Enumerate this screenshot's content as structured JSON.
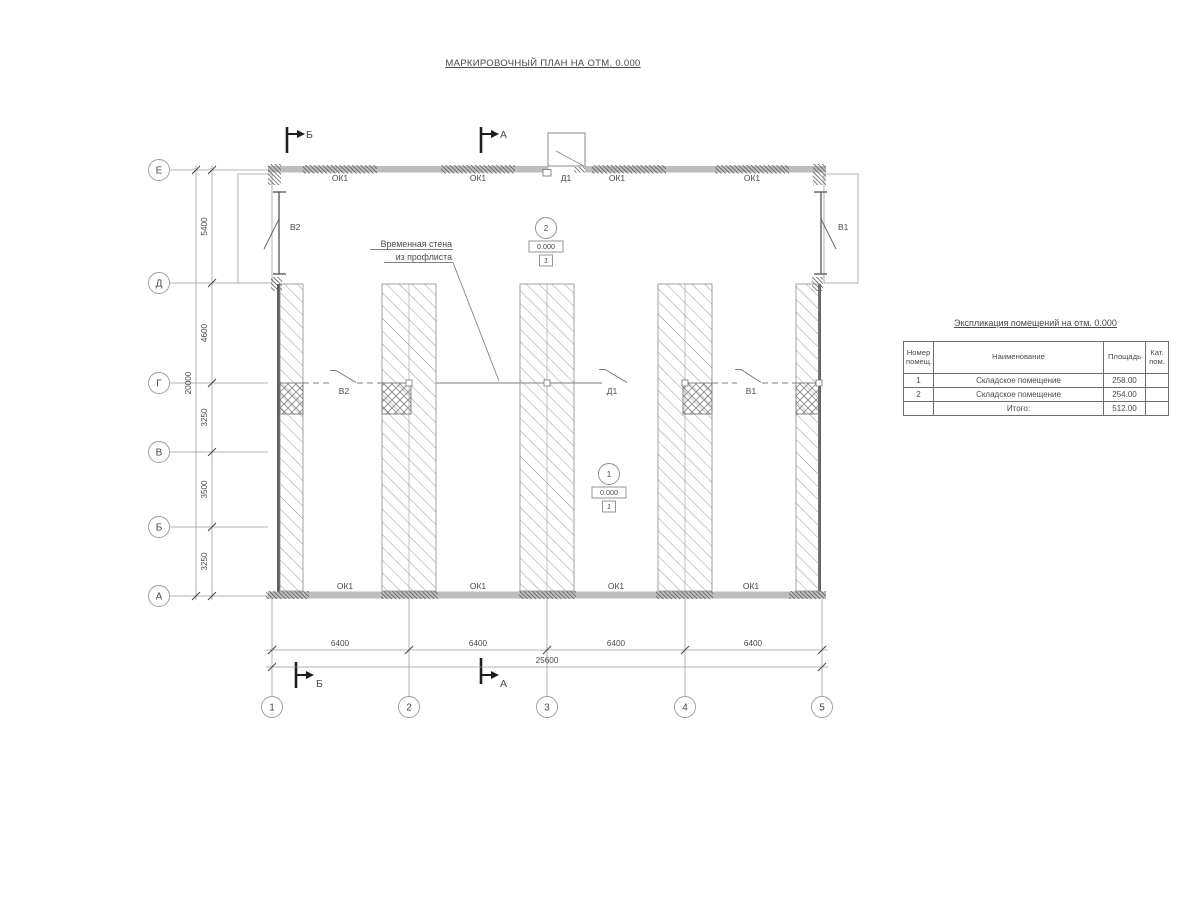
{
  "title": "МАРКИРОВОЧНЫЙ ПЛАН НА ОТМ. 0.000",
  "colors": {
    "line_light": "#9a9a9a",
    "line_dark": "#3a3a3a",
    "wall_fill": "#bdbdbd",
    "text": "#4a4a4a"
  },
  "plan": {
    "axes": {
      "rows": [
        "Е",
        "Д",
        "Г",
        "В",
        "Б",
        "А"
      ],
      "cols": [
        "1",
        "2",
        "3",
        "4",
        "5"
      ]
    },
    "dims": {
      "left_segments": [
        "5400",
        "4600",
        "3250",
        "3500",
        "3250"
      ],
      "left_total": "20000",
      "bottom_segments": [
        "6400",
        "6400",
        "6400",
        "6400"
      ],
      "bottom_total": "25600"
    },
    "labels": {
      "top_windows": [
        "ОК1",
        "ОК1",
        "ОК1",
        "ОК1"
      ],
      "bottom_windows": [
        "ОК1",
        "ОК1",
        "ОК1",
        "ОК1"
      ],
      "top_door": "Д1",
      "mid_left": "В2",
      "mid_door": "Д1",
      "mid_right": "В1",
      "side_left": "В2",
      "side_right": "В1",
      "callout_line1": "Временная стена",
      "callout_line2": "из профлиста"
    },
    "sections": {
      "top_b": "Б",
      "top_a": "А",
      "bottom_b": "Б",
      "bottom_a": "А"
    },
    "rooms": [
      {
        "number": "2",
        "elevation": "0.000",
        "category": "1"
      },
      {
        "number": "1",
        "elevation": "0.000",
        "category": "1"
      }
    ]
  },
  "table": {
    "title": "Экспликация помещений на отм. 0.000",
    "headers": {
      "col1": "Номер помещ.",
      "col2": "Наименование",
      "col3": "Площадь",
      "col4": "Кат. пом."
    },
    "rows": [
      {
        "num": "1",
        "name": "Складское помещение",
        "area": "258.00",
        "cat": ""
      },
      {
        "num": "2",
        "name": "Складское помещение",
        "area": "254.00",
        "cat": ""
      }
    ],
    "total_label": "Итого:",
    "total_value": "512.00"
  }
}
